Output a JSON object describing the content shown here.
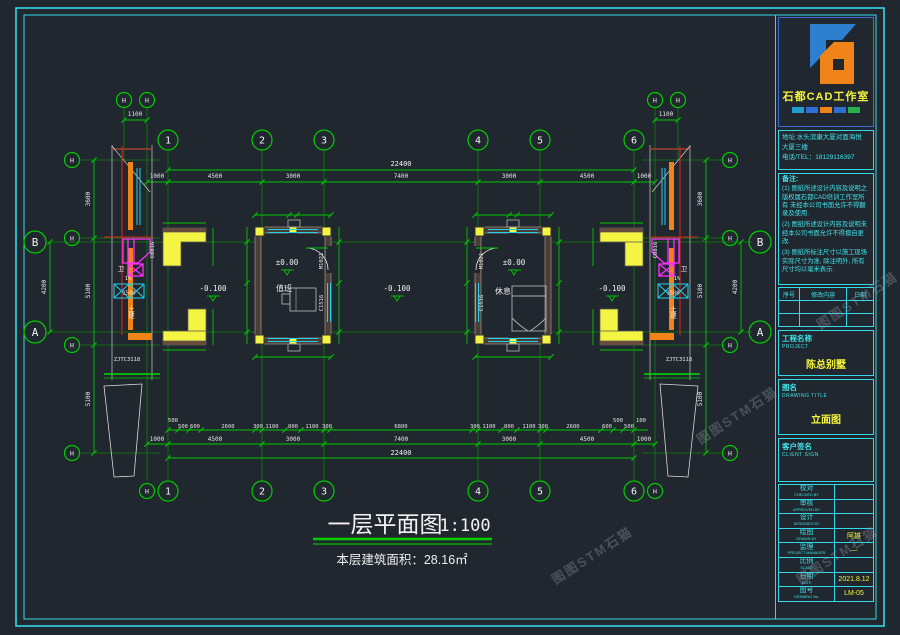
{
  "titleblock": {
    "studio_name": "石都CAD工作室",
    "address_line1": "地址:水头滨康大厦对面海悦",
    "address_line2": "大厦三楼",
    "address_line3": "电话/TEL：18129116397",
    "notes_title": "备注:",
    "note1": "(1) 图纸所述设计内容及说明之版权属石都CAD培训工作室所有 未经本公司书面允许不得翻录及使用.",
    "note2": "(2) 图纸所述设计内容及说明未经本公司书面允许不得擅自更改.",
    "note3": "(3) 图纸所标注尺寸以施工现场实际尺寸为准, 除注明外, 所有尺寸均以毫米表示.",
    "rev_headers": [
      "序号",
      "修改内容",
      "日期"
    ],
    "project_label": "工程名称",
    "project_label_en": "PROJECT",
    "project_value": "陈总别墅",
    "drawing_label": "图名",
    "drawing_label_en": "DRAWING TITLE",
    "drawing_value": "立面图",
    "client_label": "客户签名",
    "client_label_en": "CLIENT SIGN",
    "rows": [
      {
        "cn": "校对",
        "en": "CHECKED BY",
        "value": ""
      },
      {
        "cn": "审核",
        "en": "APPROVED BY",
        "value": ""
      },
      {
        "cn": "设计",
        "en": "DESIGNED BY",
        "value": ""
      },
      {
        "cn": "绘图",
        "en": "DRAWN BY",
        "value": "阿雄"
      },
      {
        "cn": "监理",
        "en": "PROJECT MANAGER",
        "value": "—"
      },
      {
        "cn": "比例",
        "en": "SCALE",
        "value": ""
      },
      {
        "cn": "日期",
        "en": "DATE",
        "value": "2021.8.12"
      },
      {
        "cn": "图号",
        "en": "DRAWING No.",
        "value": "LM-05"
      }
    ]
  },
  "plan": {
    "axes": [
      "1",
      "2",
      "3",
      "4",
      "5",
      "6"
    ],
    "sub_axis": "H",
    "axis_b": "B",
    "axis_a": "A",
    "dim_overall": "22400",
    "dims_main": [
      "1000",
      "4500",
      "3000",
      "7400",
      "3000",
      "4500",
      "1000"
    ],
    "dims_detail": [
      "500",
      "500",
      "600",
      "2600",
      "300",
      "1100",
      "800",
      "1100",
      "300",
      "6800",
      "300",
      "1100",
      "800",
      "1100",
      "300",
      "2600",
      "600",
      "500",
      "500",
      "100"
    ],
    "dims_left": [
      "3600",
      "5100",
      "5100"
    ],
    "dim_ab": "4200",
    "dim_corner": "1100",
    "dim_fence": "1500",
    "level_zero": "±0.00",
    "level_minus": "-0.100",
    "room_left": "值班",
    "room_right": "休息",
    "door_code": "M1021",
    "window_code": "C1516",
    "edge_window_code": "C0816",
    "toilet_label": "卫",
    "slope_label": "1%",
    "soil_label": "土建",
    "frame_code": "ZJTC3118",
    "title": "一层平面图",
    "scale": "1:100",
    "area_note": "本层建筑面积：28.16㎡"
  },
  "watermark": "图图STM石猫",
  "colors": {
    "line_green": "#00c800",
    "border_cyan": "#35d8e8",
    "accent_yellow": "#f4f43c",
    "magenta": "#ff2fff",
    "orange": "#f08418",
    "red": "#e02020"
  }
}
